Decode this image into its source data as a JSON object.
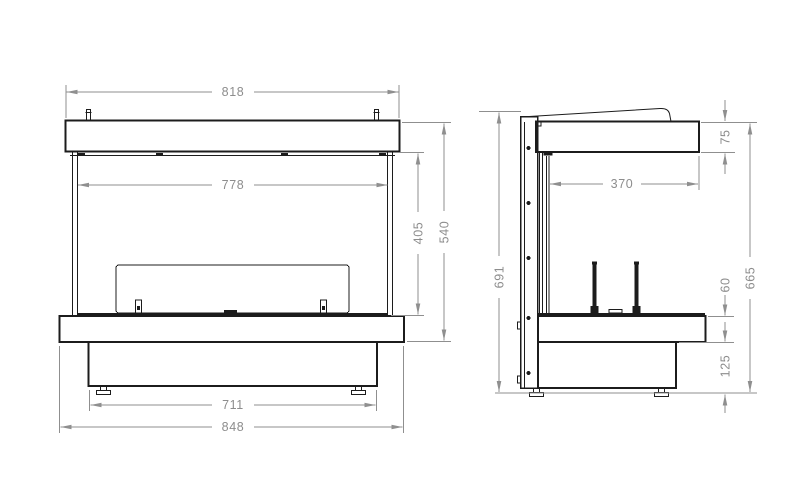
{
  "drawing": {
    "views": {
      "front": {
        "dims": {
          "cap_width": "818",
          "glass_width": "778",
          "opening_height": "405",
          "upper_height": "540",
          "base_width": "711",
          "overall_width": "848"
        }
      },
      "side": {
        "dims": {
          "hood_height": "75",
          "depth": "370",
          "back_height": "691",
          "front_height": "665",
          "burner_height": "60",
          "base_height": "125"
        }
      }
    },
    "colors": {
      "object_line": "#1c1c1c",
      "dimension_line": "#8f8f8f",
      "dimension_text": "#8d8d8d",
      "background": "#ffffff"
    }
  }
}
